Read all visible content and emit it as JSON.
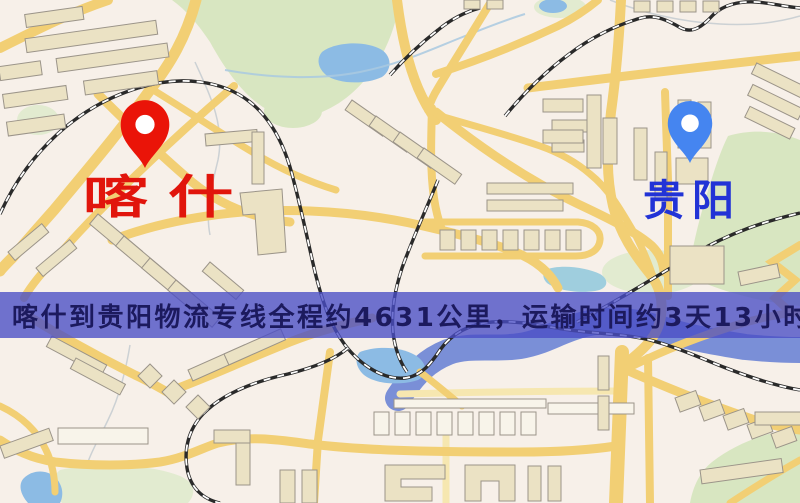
{
  "banner": {
    "text": "喀什到贵阳物流专线全程约4631公里，运输时间约3天13小时.",
    "background_color": "rgba(73,77,197,0.78)",
    "text_color": "#1c1a5e"
  },
  "markers": {
    "origin": {
      "label": "喀什",
      "pin_color": "#ea1408",
      "label_color": "#e1150c"
    },
    "destination": {
      "label": "贵阳",
      "pin_color": "#4585f0",
      "label_color": "#2233d6"
    }
  },
  "route": {
    "origin_city": "喀什",
    "destination_city": "贵阳",
    "distance_text": "约4631公里",
    "duration_text": "约3天13小时"
  },
  "map_colors": {
    "background": "#f7f0e9",
    "road": "#f2cf74",
    "road_light": "#f6e7b0",
    "park": "#d8e6c1",
    "water": "#8cbbe4",
    "river": "#7389d6",
    "building": "#ebe2c4",
    "railway": "#2a2a2a"
  }
}
